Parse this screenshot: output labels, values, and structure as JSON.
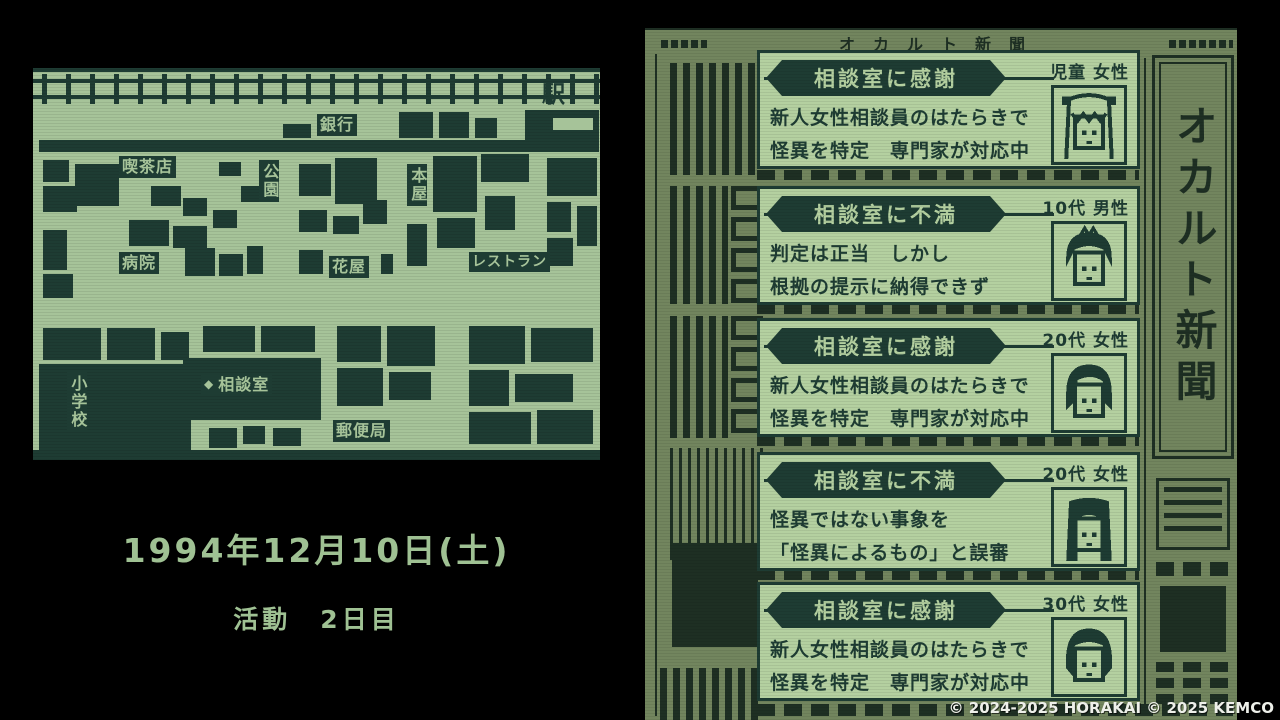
{
  "scene": {
    "date_line": "1994年12月10日(土)",
    "day_line": "活動　2日目"
  },
  "map": {
    "labels": {
      "station": "駅",
      "bank": "銀行",
      "cafe": "喫茶店",
      "park": "公園",
      "bookstore": "本屋",
      "hospital": "病院",
      "flower_shop": "花屋",
      "restaurant": "レストラン",
      "elementary_school": "小学校",
      "consult_marker": "◆",
      "consultation_room": "相談室",
      "post_office": "郵便局"
    }
  },
  "newspaper": {
    "title": "オカルト新聞",
    "masthead_vertical": "オカルト新聞",
    "cards": [
      {
        "badge": "相談室に感謝",
        "demographic": "児童 女性",
        "line1": "新人女性相談員のはたらきで",
        "line2": "怪異を特定　専門家が対応中",
        "portrait": "child-girl"
      },
      {
        "badge": "相談室に不満",
        "demographic": "10代 男性",
        "line1": "判定は正当　しかし",
        "line2": "根拠の提示に納得できず",
        "portrait": "teen-boy"
      },
      {
        "badge": "相談室に感謝",
        "demographic": "20代 女性",
        "line1": "新人女性相談員のはたらきで",
        "line2": "怪異を特定　専門家が対応中",
        "portrait": "woman-short"
      },
      {
        "badge": "相談室に不満",
        "demographic": "20代 女性",
        "line1": "怪異ではない事象を",
        "line2": "「怪異によるもの」と誤審",
        "portrait": "woman-long"
      },
      {
        "badge": "相談室に感謝",
        "demographic": "30代 女性",
        "line1": "新人女性相談員のはたらきで",
        "line2": "怪異を特定　専門家が対応中",
        "portrait": "woman-bob"
      }
    ]
  },
  "footer": {
    "copyright": "© 2024-2025 HORAKAI © 2025 KEMCO"
  },
  "colors": {
    "map_bg": "#a6c399",
    "map_ink": "#1e3c33",
    "paper_bg": "#72855e",
    "paper_ink": "#1e2f23",
    "card_bg": "#b4d0a0",
    "date_text": "#9fc193",
    "copyright_text": "#eef0ea",
    "background": "#000000"
  }
}
